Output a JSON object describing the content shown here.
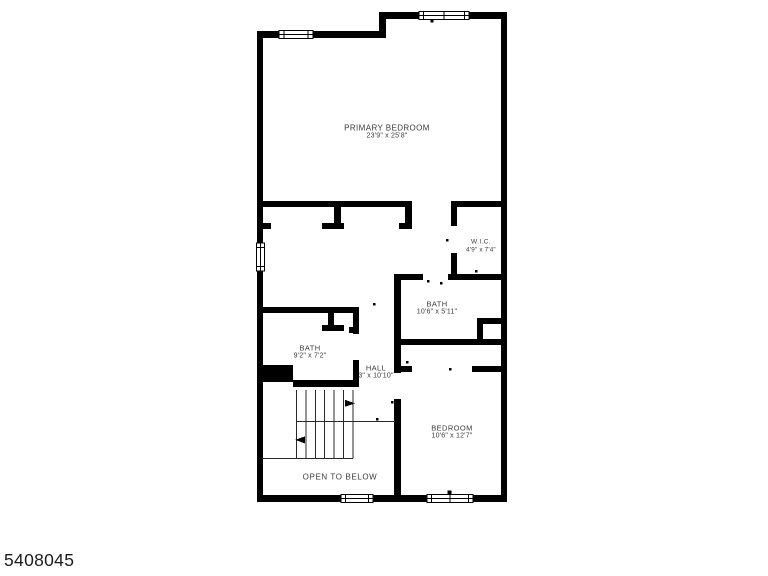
{
  "footer": {
    "listing_id": "5408045"
  },
  "rooms": {
    "primary_bedroom": {
      "name": "PRIMARY BEDROOM",
      "dimensions": "23'9\" x 25'8\""
    },
    "walk_in_closet": {
      "name": "W.I.C.",
      "dimensions": "4'9\" x 7'4\""
    },
    "bath_right": {
      "name": "BATH",
      "dimensions": "10'6\" x 5'11\""
    },
    "bath_left": {
      "name": "BATH",
      "dimensions": "9'2\" x 7'2\""
    },
    "hall": {
      "name": "HALL",
      "dimensions": "3\" x 10'10\""
    },
    "bedroom": {
      "name": "BEDROOM",
      "dimensions": "10'6\" x 12'7\""
    },
    "open_to_below": {
      "name": "OPEN TO BELOW"
    }
  },
  "colors": {
    "walls": "#000000",
    "background": "#ffffff",
    "label_text": "#3a3a3a",
    "stair_lines": "#2a2a2a"
  }
}
